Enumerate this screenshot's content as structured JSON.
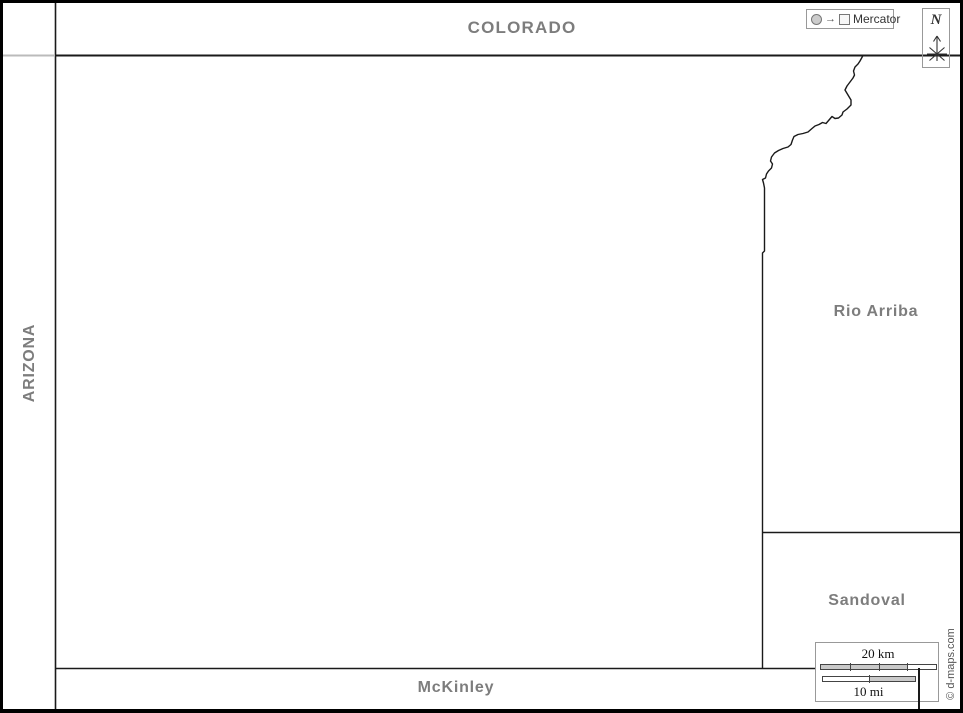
{
  "labels": {
    "colorado": "COLORADO",
    "arizona": "ARIZONA",
    "rio_arriba": "Rio Arriba",
    "sandoval": "Sandoval",
    "mckinley": "McKinley"
  },
  "projection_box": {
    "label": "Mercator",
    "arrow_glyph": "→",
    "icons": [
      "circle-icon",
      "arrow-right-icon",
      "square-icon"
    ]
  },
  "compass": {
    "label": "N",
    "icon": "compass-star-icon"
  },
  "scale_bar": {
    "km_label": "20 km",
    "mi_label": "10 mi"
  },
  "credit": {
    "text": "© d-maps.com"
  },
  "colors": {
    "label_gray": "#7d7d7d",
    "boundary_black": "#1a1a1a",
    "neatline_black": "#000000",
    "box_border_gray": "#999999",
    "scale_fill_gray": "#c9c9c9",
    "margin_line_gray": "#bbbbbb"
  }
}
